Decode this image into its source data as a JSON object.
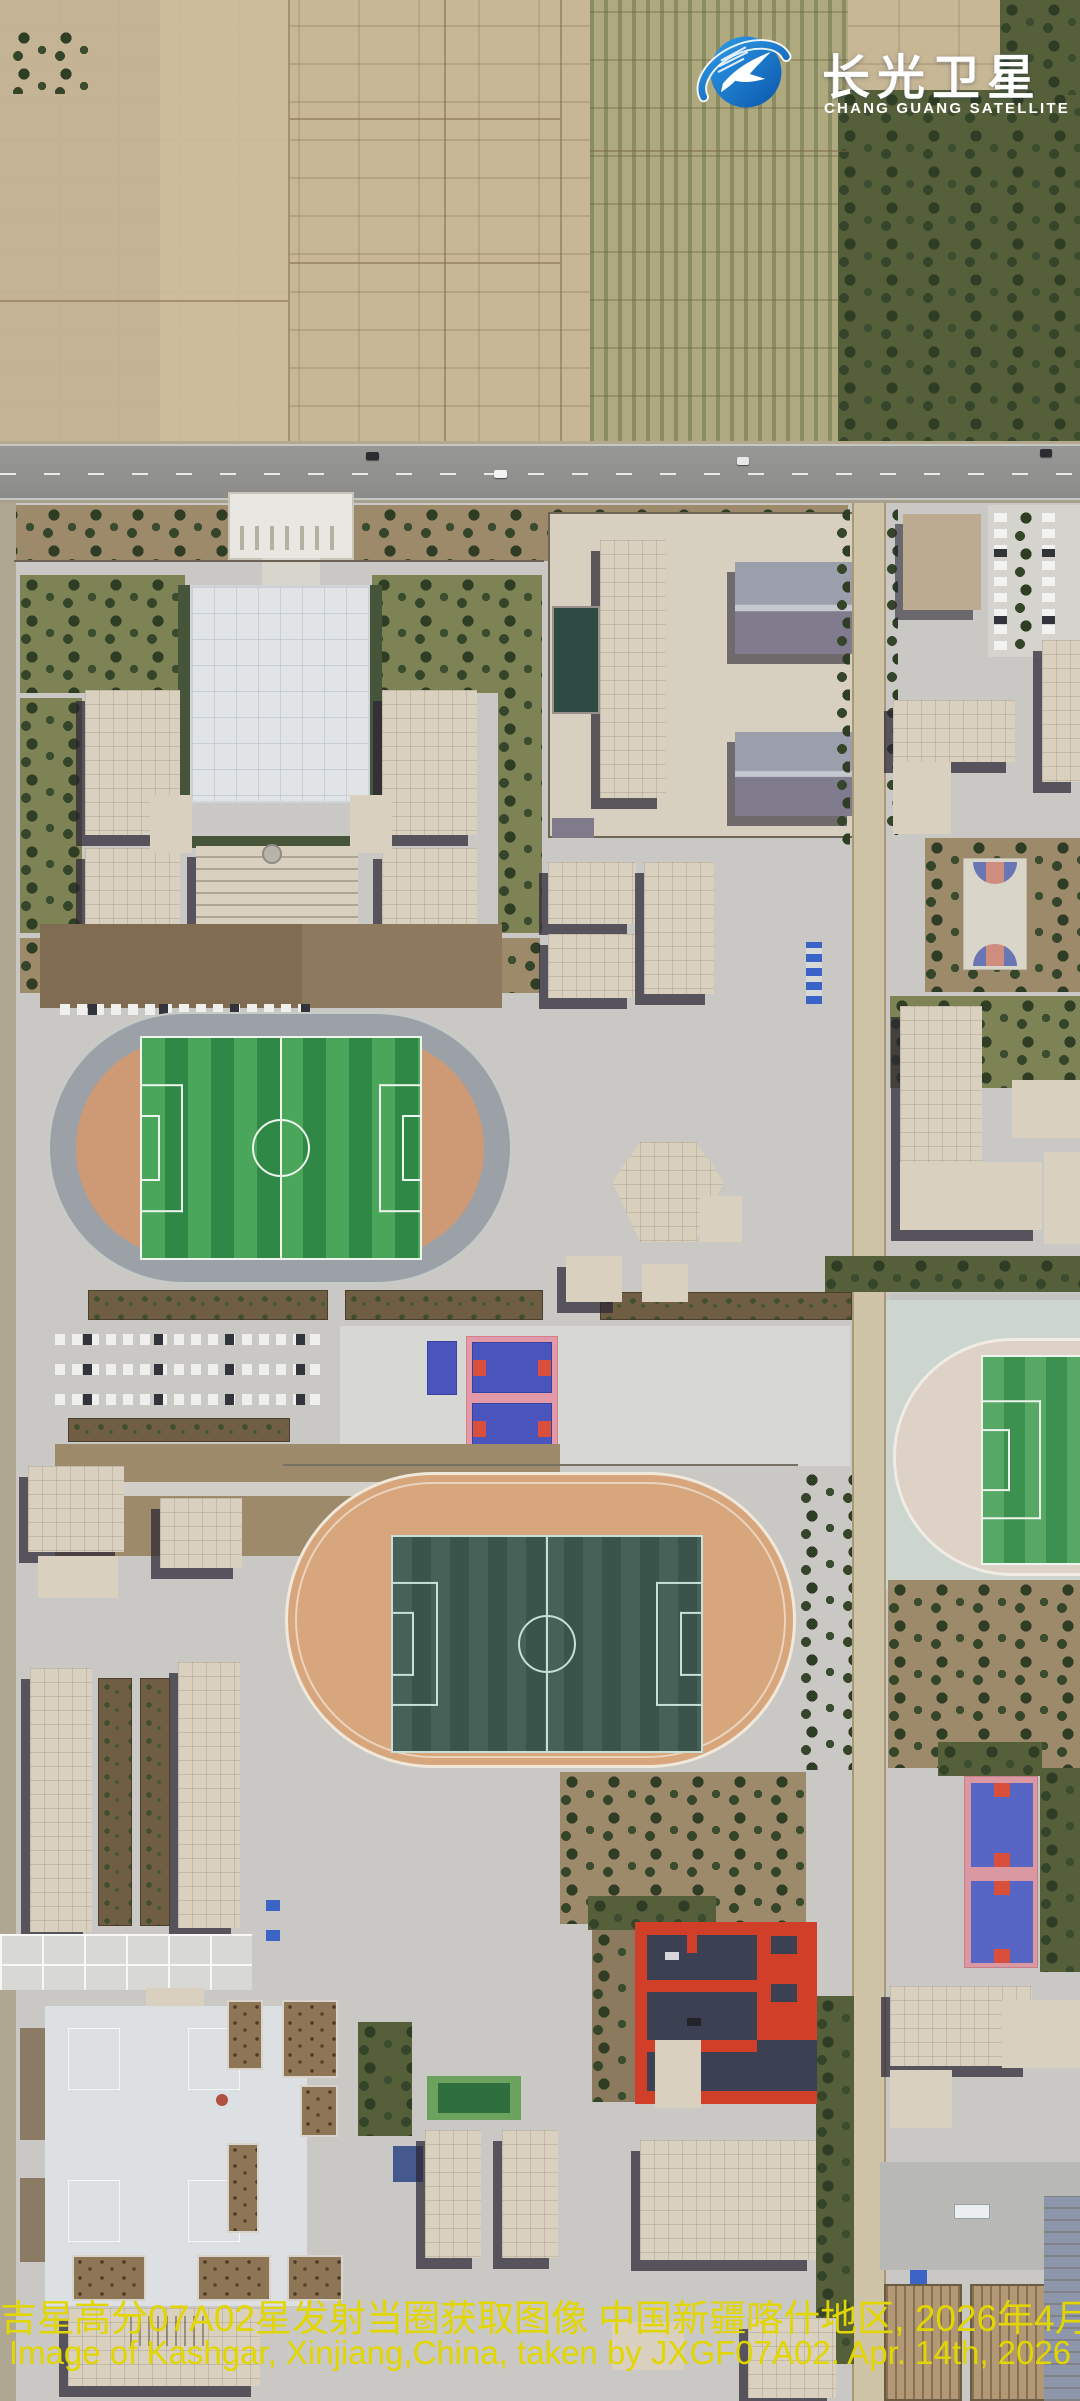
{
  "image": {
    "kind": "satellite-photograph",
    "scene": "school campus with farmland, Kashgar, Xinjiang, China"
  },
  "logo": {
    "icon": "swallow-orbit-icon",
    "title_zh": "长光卫星",
    "subtitle_en": "CHANG GUANG SATELLITE",
    "text_color": "#ffffff",
    "accent_color": "#1878cc"
  },
  "caption": {
    "line1_zh": "吉星高分07A02星发射当圈获取图像 中国新疆喀什地区, 2026年4月14日",
    "line2_en": "Image of Kashgar, Xinjiang,China, taken by JXGF07A02. Apr. 14th, 2026",
    "color": "#e2d600"
  },
  "palette": {
    "farmland_tan": "#c7b795",
    "orchard_green": "#afa97f",
    "tree_dark_green": "#35452a",
    "road_asphalt": "#919191",
    "campus_concrete": "#c9c8c4",
    "plaza_white": "#dde0e2",
    "building_cream": "#d9d0bf",
    "building_brown_roof": "#8d7556",
    "building_shadow": "#2b2634",
    "metal_roof_gray": "#8f8b9c",
    "track1_ring_gray": "#9ba1a7",
    "track1_infield_salmon": "#cd9a75",
    "track2_ring_tan": "#d7a67d",
    "pitch_bright_green": "#49a65a",
    "pitch_dark_green": "#3d5950",
    "court_blue": "#4a55be",
    "court_red": "#d8503c",
    "court_pink_frame": "#e39aa8",
    "red_corridor_building": "#d13f28",
    "pool_teal": "#2d4b43",
    "caption_yellow": "#e2d600",
    "logo_blue": "#1878cc"
  },
  "scene_features": [
    "farmland",
    "orchard",
    "tree-groves",
    "highway-road",
    "campus-entrance-gate",
    "courtyard",
    "running-track-west",
    "running-track-center",
    "running-track-east-partial",
    "football-pitches",
    "basketball-courts",
    "parking-lots",
    "dormitory-rows",
    "red-corridor-complex",
    "swimming-pool",
    "greenhouse-sheds",
    "plaza-courts"
  ]
}
